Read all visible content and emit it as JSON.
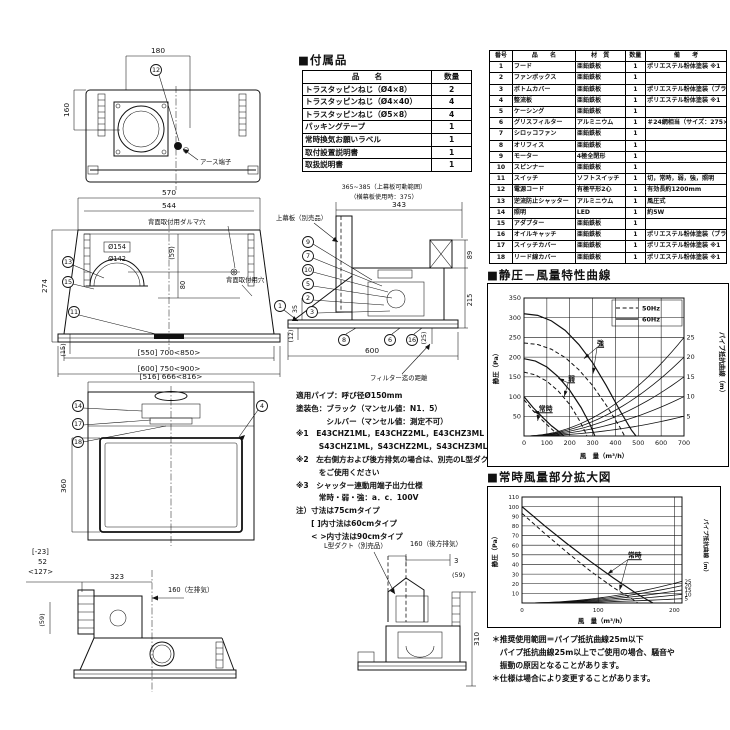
{
  "accessories": {
    "title": "■付属品",
    "headers": [
      "品　　名",
      "数量"
    ],
    "rows": [
      [
        "トラスタッピンねじ（Ø4×8）",
        "2"
      ],
      [
        "トラスタッピンねじ（Ø4×40）",
        "4"
      ],
      [
        "トラスタッピンねじ（Ø5×8）",
        "4"
      ],
      [
        "パッキングテープ",
        "1"
      ],
      [
        "常時換気お願いラベル",
        "1"
      ],
      [
        "取付設置説明書",
        "1"
      ],
      [
        "取扱説明書",
        "1"
      ]
    ]
  },
  "parts": {
    "headers": [
      "番号",
      "品　　名",
      "材　質",
      "数量",
      "備　　考"
    ],
    "rows": [
      [
        "1",
        "フード",
        "亜鉛鉄板",
        "1",
        "ポリエステル粉体塗装 ※1"
      ],
      [
        "2",
        "ファンボックス",
        "亜鉛鉄板",
        "1",
        ""
      ],
      [
        "3",
        "ボトムカバー",
        "亜鉛鉄板",
        "1",
        "ポリエステル粉体塗装（ブラック）"
      ],
      [
        "4",
        "整流板",
        "亜鉛鉄板",
        "1",
        "ポリエステル粉体塗装 ※1"
      ],
      [
        "5",
        "ケーシング",
        "亜鉛鉄板",
        "1",
        ""
      ],
      [
        "6",
        "グリスフィルター",
        "アルミニウム",
        "1",
        "＃24網相当（サイズ：275×297）"
      ],
      [
        "7",
        "シロッコファン",
        "亜鉛鉄板",
        "1",
        ""
      ],
      [
        "8",
        "オリフィス",
        "亜鉛鉄板",
        "1",
        ""
      ],
      [
        "9",
        "モーター",
        "4極全閉形",
        "1",
        ""
      ],
      [
        "10",
        "スピンナー",
        "亜鉛鉄板",
        "1",
        ""
      ],
      [
        "11",
        "スイッチ",
        "ソフトスイッチ",
        "1",
        "切，常時，弱，強，照明"
      ],
      [
        "12",
        "電源コード",
        "有極平形2心",
        "1",
        "有効長約1200mm"
      ],
      [
        "13",
        "逆流防止シャッター",
        "アルミニウム",
        "1",
        "風圧式"
      ],
      [
        "14",
        "照明",
        "LED",
        "1",
        "約5W"
      ],
      [
        "15",
        "アダプター",
        "亜鉛鉄板",
        "1",
        ""
      ],
      [
        "16",
        "オイルキャッチ",
        "亜鉛鉄板",
        "1",
        "ポリエステル粉体塗装（ブラック）"
      ],
      [
        "17",
        "スイッチカバー",
        "亜鉛鉄板",
        "1",
        "ポリエステル粉体塗装 ※1"
      ],
      [
        "18",
        "リード線カバー",
        "亜鉛鉄板",
        "1",
        "ポリエステル粉体塗装 ※1"
      ]
    ]
  },
  "specs": {
    "lines": [
      "適用パイプ：呼び径Ø150mm",
      "塗装色：ブラック（マンセル値：N1．5）",
      "　　　　シルバー（マンセル値：測定不可）",
      "※1　E43CHZ1ML，E43CHZ2ML，E43CHZ3ML（ブラック）",
      "　　　S43CHZ1ML，S43CHZ2ML，S43CHZ3ML（シルバー）",
      "※2　左右側方および後方排気の場合は、別売のL型ダクト",
      "　　　をご使用ください",
      "※3　シャッター連動用端子出力仕様",
      "　　　常時・弱・強：a．c．100V",
      "注）寸法は75cmタイプ",
      "　　[ ]内寸法は60cmタイプ",
      "　　< >内寸法は90cmタイプ"
    ]
  },
  "notes": {
    "lines": [
      "＊推奨使用範囲＝パイプ抵抗曲線25m以下",
      "　パイプ抵抗曲線25m以上でご使用の場合、騒音や",
      "　振動の原因となることがあります。",
      "＊仕様は場合により変更することがあります。"
    ]
  },
  "drawings": {
    "top_view": {
      "dim_180": "180",
      "dim_160": "160",
      "callout_12": "12",
      "earth_label": "アース端子"
    },
    "front_view": {
      "dim_570": "570",
      "dim_544": "544",
      "dim_d154": "Ø154",
      "dim_d142": "Ø142",
      "dim_59": "(59)",
      "dim_80": "80",
      "dim_274": "274",
      "dim_15": "(15)",
      "dim_w1": "[550] 700<850>",
      "dim_w2": "[600] 750<900>",
      "label_daruma": "背面取付用ダルマ穴",
      "label_hole": "背面取付用穴",
      "callout_13": "13",
      "callout_15": "15",
      "callout_11": "11"
    },
    "bottom_view": {
      "dim_w": "[516] 666<816>",
      "dim_360": "360",
      "callout_14": "14",
      "callout_17": "17",
      "callout_18": "18",
      "callout_4": "4"
    },
    "side_view": {
      "dim_range": "365~385（上幕板可動範囲）",
      "dim_range2": "（横幕板使用時：375）",
      "dim_343": "343",
      "dim_89": "89",
      "dim_215": "215",
      "dim_25": "(25)",
      "dim_600": "600",
      "dim_35": "35",
      "dim_12": "(12)",
      "label_kamaita": "上幕板（別売品）",
      "label_filter": "フィルター迄の距離",
      "c9": "9",
      "c7": "7",
      "c10": "10",
      "c5": "5",
      "c2": "2",
      "c3": "3",
      "c1": "1",
      "c8": "8",
      "c6": "6",
      "c16": "16"
    },
    "left_exhaust_view": {
      "dim_m23": "[-23]",
      "dim_52": "52",
      "dim_127": "<127>",
      "dim_323": "323",
      "dim_160": "160（左排気）",
      "dim_59": "(59)"
    },
    "rear_exhaust_view": {
      "label_duct": "L型ダクト（別売品）",
      "dim_160": "160（後方排気）",
      "dim_3": "3",
      "dim_59": "(59)",
      "dim_310": "310"
    }
  },
  "chart_data": [
    {
      "type": "line",
      "title": "■静圧－風量特性曲線",
      "xlabel": "風　量（m³/h）",
      "ylabel": "静圧（Pa）",
      "y2label": "パイプ抵抗曲線（m）",
      "xlim": [
        0,
        700
      ],
      "ylim": [
        0,
        350
      ],
      "xticks": [
        0,
        100,
        200,
        300,
        400,
        500,
        600,
        700
      ],
      "yticks": [
        50,
        100,
        150,
        200,
        250,
        300,
        350
      ],
      "grid": true,
      "legend": [
        {
          "label": "50Hz",
          "style": "dashed"
        },
        {
          "label": "60Hz",
          "style": "solid"
        }
      ],
      "series": [
        {
          "name": "強 60Hz",
          "style": "solid",
          "points": [
            [
              0,
              310
            ],
            [
              60,
              306
            ],
            [
              120,
              292
            ],
            [
              180,
              268
            ],
            [
              240,
              232
            ],
            [
              300,
              186
            ],
            [
              360,
              128
            ],
            [
              420,
              64
            ],
            [
              470,
              15
            ],
            [
              490,
              0
            ]
          ]
        },
        {
          "name": "強 50Hz",
          "style": "dashed",
          "points": [
            [
              0,
              236
            ],
            [
              60,
              232
            ],
            [
              120,
              220
            ],
            [
              180,
              199
            ],
            [
              240,
              168
            ],
            [
              300,
              128
            ],
            [
              360,
              78
            ],
            [
              420,
              22
            ],
            [
              440,
              0
            ]
          ]
        },
        {
          "name": "弱 60Hz",
          "style": "solid",
          "points": [
            [
              0,
              196
            ],
            [
              50,
              190
            ],
            [
              100,
              175
            ],
            [
              150,
              150
            ],
            [
              200,
              116
            ],
            [
              250,
              72
            ],
            [
              290,
              28
            ],
            [
              310,
              0
            ]
          ]
        },
        {
          "name": "弱 50Hz",
          "style": "dashed",
          "points": [
            [
              0,
              162
            ],
            [
              50,
              155
            ],
            [
              100,
              139
            ],
            [
              150,
              114
            ],
            [
              200,
              80
            ],
            [
              240,
              42
            ],
            [
              270,
              8
            ],
            [
              275,
              0
            ]
          ]
        },
        {
          "name": "常時 60Hz",
          "style": "solid",
          "points": [
            [
              0,
              100
            ],
            [
              40,
              72
            ],
            [
              80,
              48
            ],
            [
              120,
              26
            ],
            [
              160,
              8
            ],
            [
              175,
              0
            ]
          ]
        },
        {
          "name": "常時 50Hz",
          "style": "dashed",
          "points": [
            [
              0,
              92
            ],
            [
              40,
              64
            ],
            [
              80,
              40
            ],
            [
              120,
              18
            ],
            [
              150,
              3
            ],
            [
              155,
              0
            ]
          ]
        }
      ],
      "pipe_curves": [
        {
          "label": "5",
          "y_at_700": 50
        },
        {
          "label": "10",
          "y_at_700": 100
        },
        {
          "label": "15",
          "y_at_700": 150
        },
        {
          "label": "20",
          "y_at_700": 200
        },
        {
          "label": "25",
          "y_at_700": 250
        }
      ],
      "annotations": [
        {
          "text": "強",
          "x": 335,
          "y": 230,
          "targets": [
            [
              262,
              196
            ],
            [
              302,
              158
            ]
          ]
        },
        {
          "text": "弱",
          "x": 208,
          "y": 140,
          "targets": [
            [
              150,
              146
            ],
            [
              176,
              100
            ]
          ]
        },
        {
          "text": "常時",
          "x": 95,
          "y": 64,
          "targets": [
            [
              40,
              62
            ],
            [
              60,
              38
            ]
          ]
        }
      ]
    },
    {
      "type": "line",
      "title": "■常時風量部分拡大図",
      "xlabel": "風　量（m³/h）",
      "ylabel": "静圧（Pa）",
      "y2label": "パイプ抵抗曲線（m）",
      "xlim": [
        0,
        210
      ],
      "ylim": [
        0,
        110
      ],
      "xticks": [
        0,
        100,
        200
      ],
      "yticks": [
        10,
        20,
        30,
        40,
        50,
        60,
        70,
        80,
        90,
        100,
        110
      ],
      "grid": true,
      "legend": [],
      "series": [
        {
          "name": "常時 60Hz",
          "style": "solid",
          "points": [
            [
              0,
              100
            ],
            [
              30,
              80
            ],
            [
              60,
              61
            ],
            [
              90,
              43
            ],
            [
              120,
              26
            ],
            [
              150,
              10
            ],
            [
              165,
              3
            ],
            [
              172,
              0
            ]
          ]
        },
        {
          "name": "常時 50Hz",
          "style": "dashed",
          "points": [
            [
              0,
              93
            ],
            [
              30,
              72
            ],
            [
              60,
              52
            ],
            [
              90,
              33
            ],
            [
              120,
              16
            ],
            [
              145,
              4
            ],
            [
              152,
              0
            ]
          ]
        }
      ],
      "pipe_curves": [
        {
          "label": "5",
          "y_at_700": 50
        },
        {
          "label": "10",
          "y_at_700": 100
        },
        {
          "label": "15",
          "y_at_700": 150
        },
        {
          "label": "20",
          "y_at_700": 200
        },
        {
          "label": "25",
          "y_at_700": 250
        }
      ],
      "annotations": [
        {
          "text": "常時",
          "x": 148,
          "y": 47,
          "targets": [
            [
              112,
              30
            ],
            [
              128,
              13
            ]
          ]
        }
      ]
    }
  ]
}
